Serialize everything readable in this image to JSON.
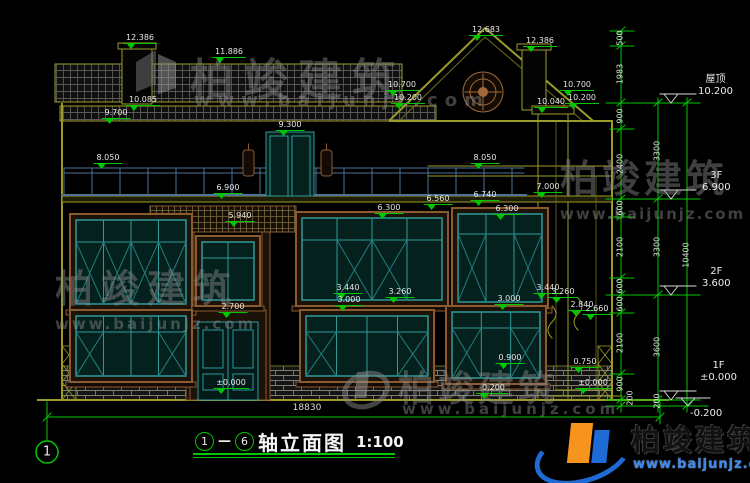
{
  "title": {
    "axis_from": "1",
    "dash": "—",
    "axis_to": "6",
    "name": "轴立面图",
    "scale": "1:100"
  },
  "axis_bubble": "1",
  "bottom_dim": "18830",
  "levels": {
    "roof": {
      "label": "屋顶",
      "value": "10.200"
    },
    "f3": {
      "label": "3F",
      "value": "6.900"
    },
    "f2": {
      "label": "2F",
      "value": "3.600"
    },
    "f1": {
      "label": "1F",
      "value": "±0.000"
    },
    "below": "-0.200"
  },
  "chains": {
    "inner": [
      "500",
      "1983",
      "900",
      "2400",
      "600",
      "2100",
      "600",
      "600",
      "2100",
      "900",
      "200"
    ],
    "middle": [
      "3300",
      "3300",
      "3600",
      "200"
    ],
    "outer": [
      "10400"
    ]
  },
  "marks": [
    "12.386",
    "11.886",
    "12.683",
    "12.386",
    "10.700",
    "10.200",
    "10.700",
    "10.200",
    "10.040",
    "10.085",
    "9.700",
    "9.300",
    "8.050",
    "8.050",
    "7.000",
    "6.900",
    "5.940",
    "6.300",
    "6.560",
    "6.740",
    "6.300",
    "3.440",
    "3.260",
    "3.000",
    "2.700",
    "±0.000",
    "3.440",
    "3.260",
    "3.000",
    "2.840",
    "2.660",
    "0.900",
    "0.750",
    "±0.000",
    "-0.200"
  ],
  "watermark": {
    "brand": "柏竣建筑",
    "url": "www.baijunjz.com"
  },
  "logo": {
    "brand": "柏竣建筑",
    "url": "www.baijunjz.com"
  },
  "colors": {
    "dim_green": "#00c800",
    "wall_olive": "#9b9b2a",
    "frame_teal": "#2e9a9a",
    "trim_brown": "#8a5a30",
    "logo_blue": "#1e6bd6",
    "logo_orange": "#f7941d"
  }
}
